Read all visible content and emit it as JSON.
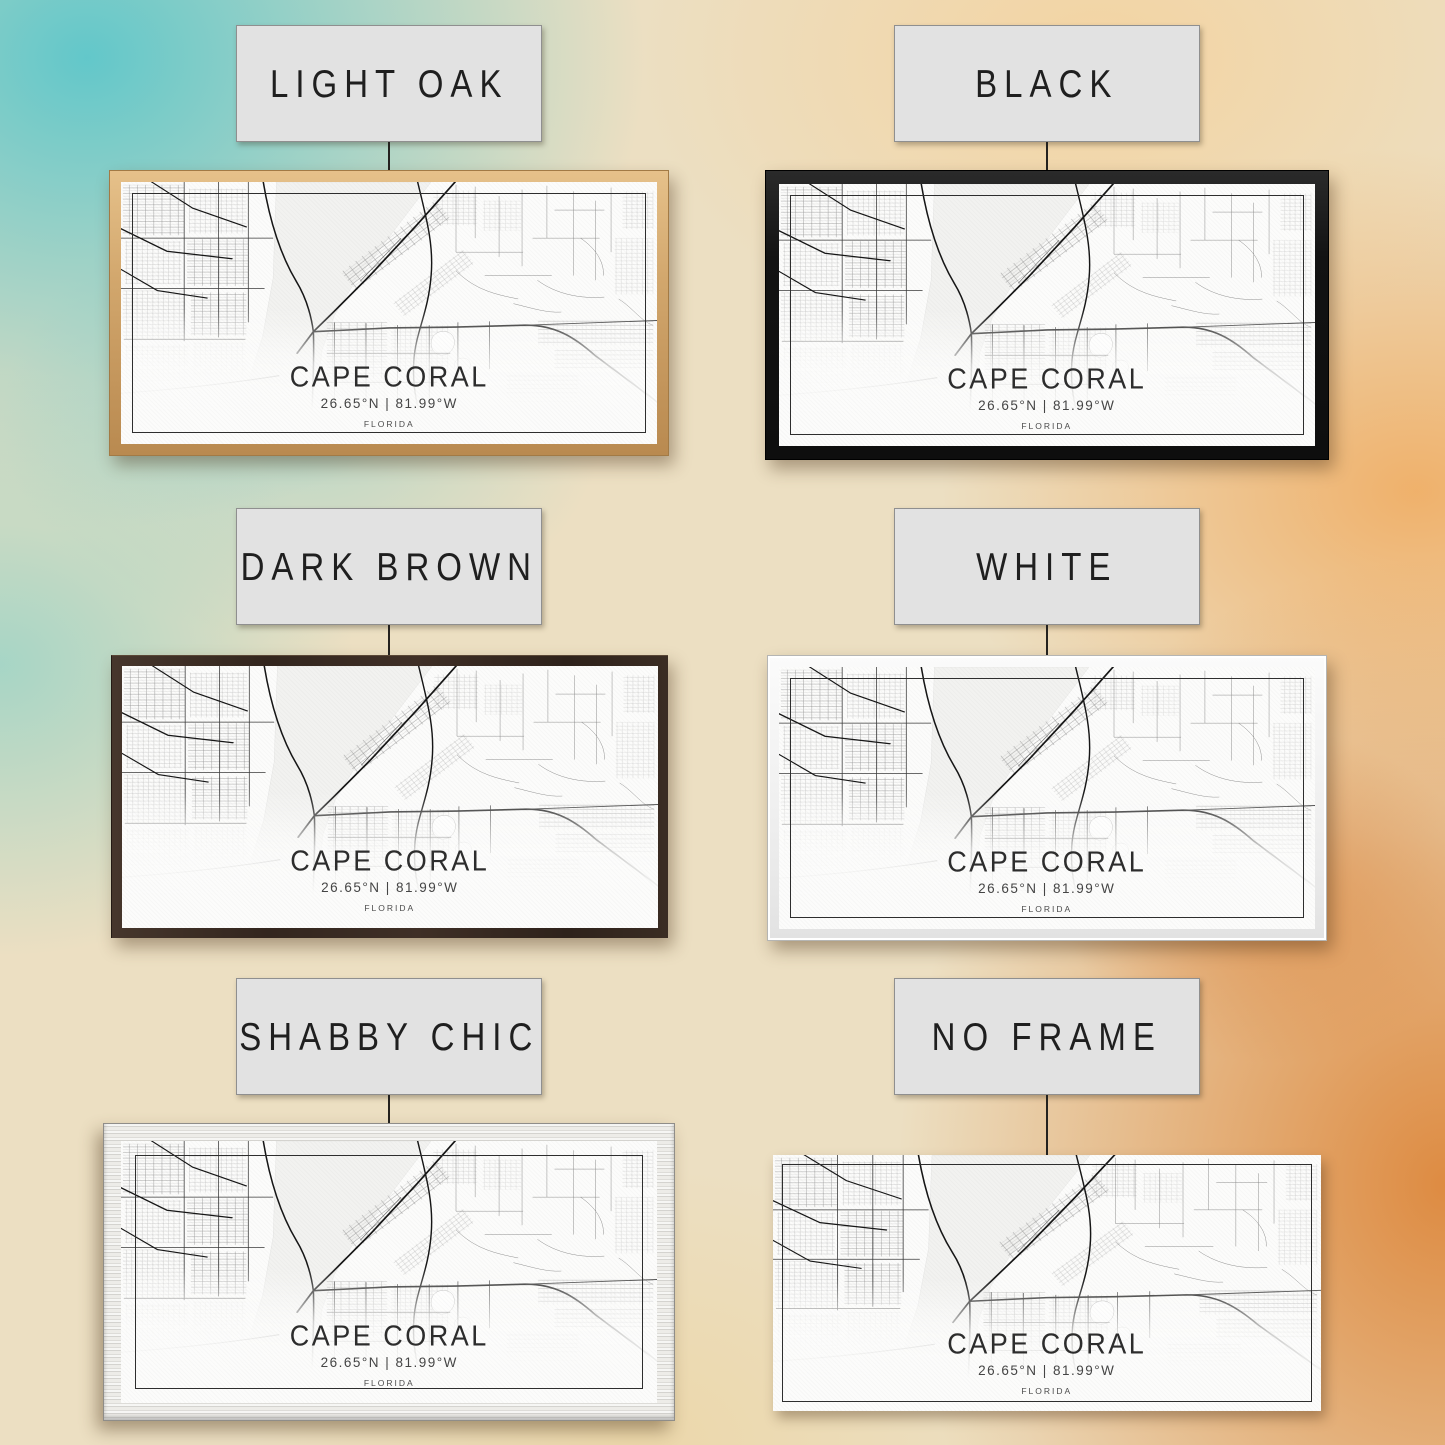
{
  "options": [
    {
      "id": "light-oak",
      "label": "LIGHT OAK"
    },
    {
      "id": "black",
      "label": "BLACK"
    },
    {
      "id": "dark-brown",
      "label": "DARK BROWN"
    },
    {
      "id": "white",
      "label": "WHITE"
    },
    {
      "id": "shabby-chic",
      "label": "SHABBY CHIC"
    },
    {
      "id": "no-frame",
      "label": "NO FRAME"
    }
  ],
  "print": {
    "city": "CAPE CORAL",
    "coordinates": "26.65°N | 81.99°W",
    "state": "FLORIDA"
  },
  "colors": {
    "label_card_bg": "#e2e2e2",
    "frame_light_oak": "#d2a76d",
    "frame_black": "#131313",
    "frame_dark_brown": "#33261e",
    "frame_white": "#f0f0f0",
    "frame_shabby_chic": "#e9e8e4",
    "canvas": "#fcfcfb",
    "map_roads": "#161616",
    "background_teal": "#5bc6ca",
    "background_cream": "#ecdfc2",
    "background_orange": "#f0a95c",
    "background_deep_orange": "#dc8234"
  }
}
